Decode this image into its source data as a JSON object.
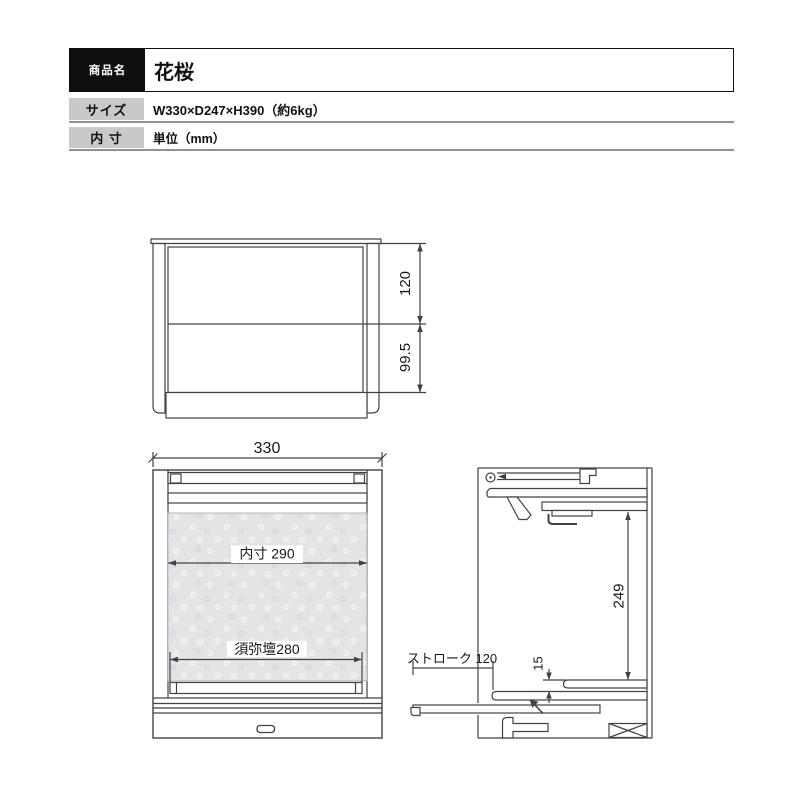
{
  "spec_table": {
    "rows": [
      {
        "label": "商品名",
        "value": "花桜"
      },
      {
        "label": "サイズ",
        "value": "W330×D247×H390（約6kg）"
      },
      {
        "label": "内 寸",
        "value": "単位（mm）"
      }
    ]
  },
  "diagram": {
    "front_closed": {
      "upper_height": "120",
      "lower_height": "99.5"
    },
    "front_open": {
      "overall_width": "330",
      "inner_width": "内寸 290",
      "dais_width": "須弥壇280"
    },
    "side_view": {
      "inner_height": "249",
      "slide_stroke": "ストローク 120",
      "shelf_gap": "15"
    }
  },
  "colors": {
    "line": "#3f4348",
    "panel_gray": "#e2e4e6",
    "table_label_bg": "#c8c9cb",
    "table_rule": "#8f9193",
    "header_bg": "#0f0f0f"
  }
}
